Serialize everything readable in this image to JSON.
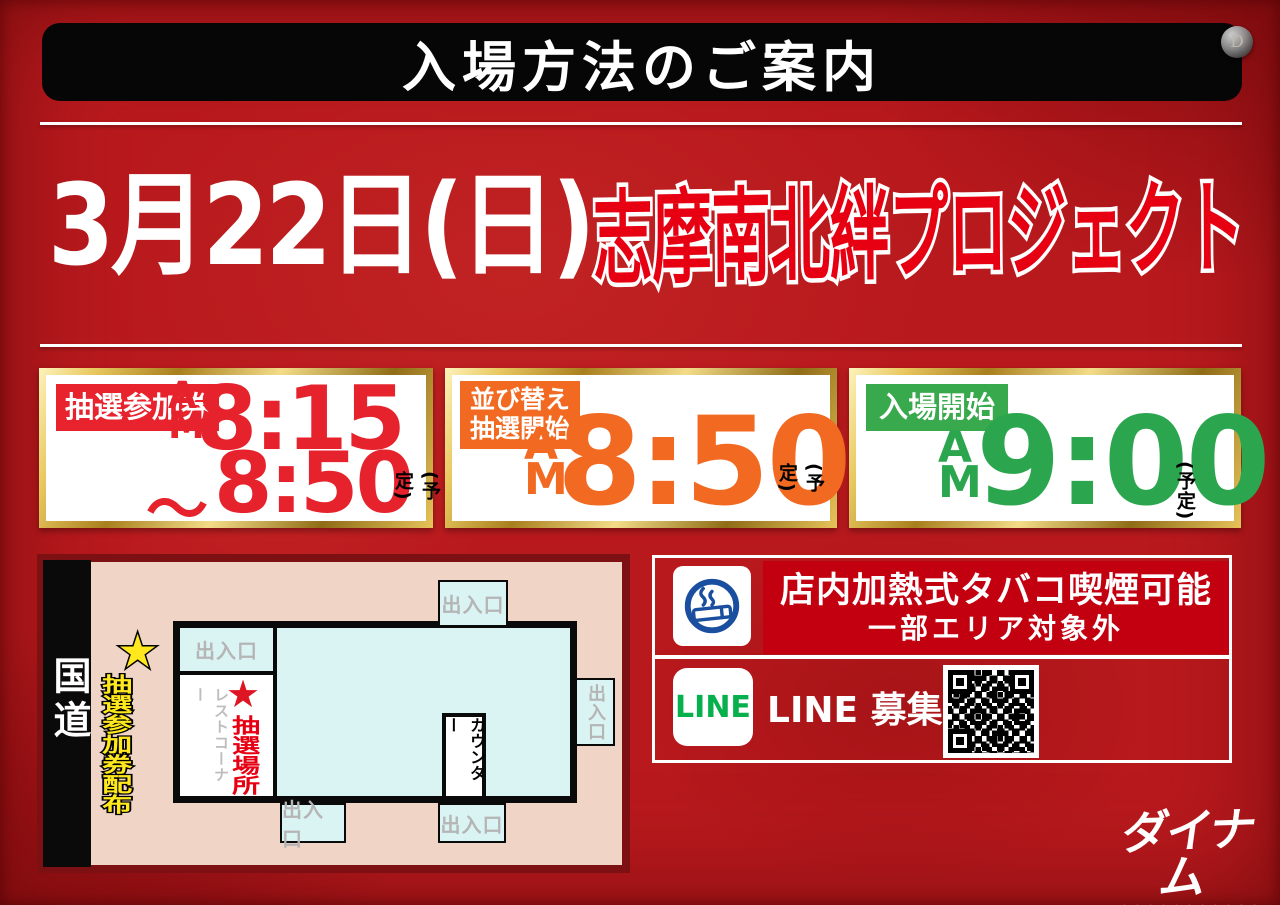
{
  "header": {
    "title": "入場方法のご案内",
    "pin_letter": "D"
  },
  "event": {
    "date": "3月22日(日)",
    "name": "志摩南北絆プロジェクト"
  },
  "schedule": {
    "am": "AM",
    "note": "(予定)",
    "box1": {
      "label": "抽選参加券",
      "time_start": "8:15",
      "tilde": "〜",
      "time_end": "8:50",
      "color": "#e6222d"
    },
    "box2": {
      "label_line1": "並び替え",
      "label_line2": "抽選開始",
      "time": "8:50",
      "color": "#f26a21"
    },
    "box3": {
      "label": "入場開始",
      "time": "9:00",
      "color": "#2ca64e"
    }
  },
  "map": {
    "road": "国道",
    "star": "★",
    "ticket_distribution": "抽選参加券配布",
    "entrance": "出入口",
    "rest_corner": "レストコーナー",
    "lottery_star": "★",
    "lottery_place": "抽選場所",
    "counter": "カウンター"
  },
  "info": {
    "smoking_title": "店内加熱式タバコ喫煙可能",
    "smoking_sub": "一部エリア対象外",
    "line_logo": "LINE",
    "line_text": "LINE 募集",
    "line_arrow": "▶"
  },
  "brand": {
    "name": "ダイナム"
  },
  "colors": {
    "background_red": "#b8191d",
    "accent_red": "#e60012",
    "accent_orange": "#f26a21",
    "accent_green": "#2ca64e",
    "gold_border": "#caa03a",
    "line_green": "#06b04c",
    "smoking_blue": "#1a4fa0",
    "map_pink": "#f0d5c6",
    "map_cyan": "#d9f4f3",
    "band_red": "#c30010"
  }
}
